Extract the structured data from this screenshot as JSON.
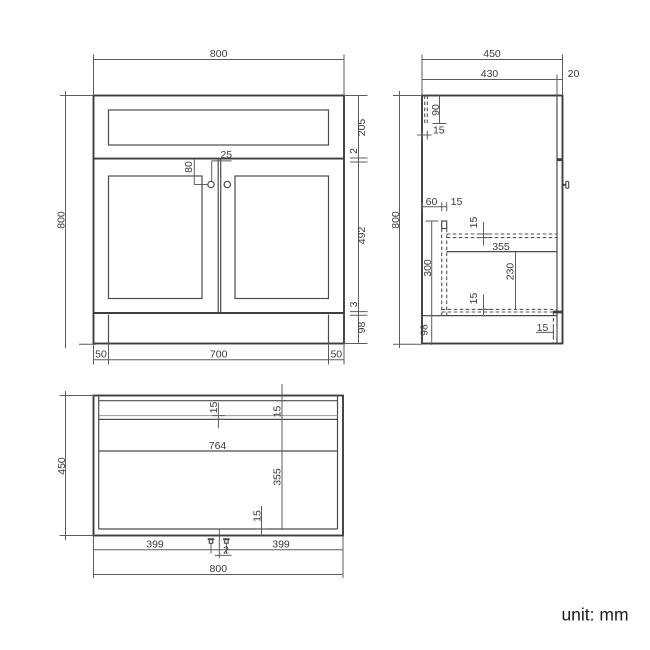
{
  "drawing": {
    "background_color": "#ffffff",
    "line_color": "#4a4a50",
    "text_color": "#3b3b3e"
  },
  "front_view": {
    "overall_width_mm": "800",
    "overall_height_mm": "800",
    "drawer_front_height_mm": "205",
    "drawer_door_gap_mm": "2",
    "door_height_mm": "492",
    "door_plinth_gap_mm": "3",
    "plinth_height_mm": "98",
    "plinth_inset_left_mm": "50",
    "plinth_width_mm": "700",
    "plinth_inset_right_mm": "50",
    "knob_drop_mm": "80",
    "knob_offset_mm": "25"
  },
  "side_view": {
    "overall_depth_mm": "450",
    "carcass_depth_mm": "430",
    "door_thickness_mm": "20",
    "overall_height_mm": "800",
    "back_detail_height_mm": "90",
    "back_panel_thickness_mm": "15",
    "runner_setback_mm": "60",
    "runner_width_mm": "15",
    "shelf_thickness_mm": "15",
    "shelf_depth_mm": "355",
    "shelf_to_bottom_mm": "230",
    "bottom_panel_thickness_mm": "15",
    "interior_height_mm": "300",
    "plinth_height_mm": "98",
    "plinth_recess_mm": "15"
  },
  "plan_view": {
    "overall_depth_mm": "450",
    "back_rail_thickness_mm": "15",
    "back_panel_thickness_mm": "15",
    "interior_width_mm": "764",
    "interior_depth_mm": "355",
    "front_rail_thickness_mm": "15",
    "knob_from_left_mm": "399",
    "door_gap_mm": "2",
    "knob_from_right_mm": "399",
    "overall_width_mm": "800"
  },
  "footer": {
    "unit_note": "unit: mm"
  }
}
